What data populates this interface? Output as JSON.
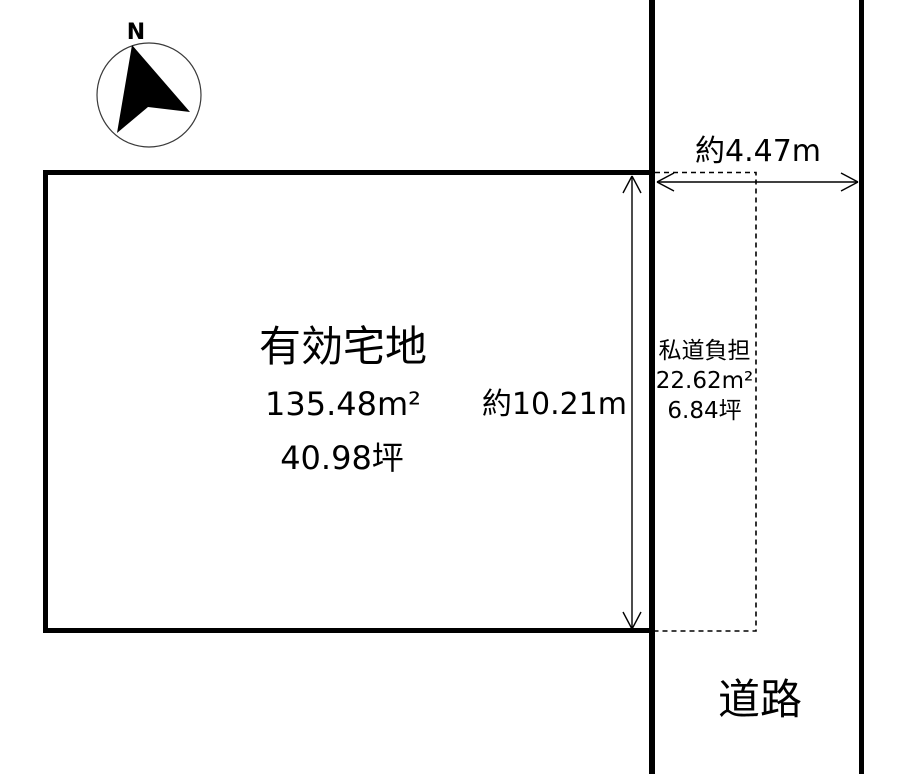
{
  "colors": {
    "line": "#000000",
    "background": "#ffffff"
  },
  "compass": {
    "label": "N"
  },
  "main_plot": {
    "title": "有効宅地",
    "area_m2": "135.48m²",
    "area_tsubo": "40.98坪"
  },
  "dimensions": {
    "depth_label": "約10.21m",
    "width_label": "約4.47m"
  },
  "private_road": {
    "title": "私道負担",
    "area_m2": "22.62m²",
    "area_tsubo": "6.84坪"
  },
  "road": {
    "label": "道路"
  }
}
